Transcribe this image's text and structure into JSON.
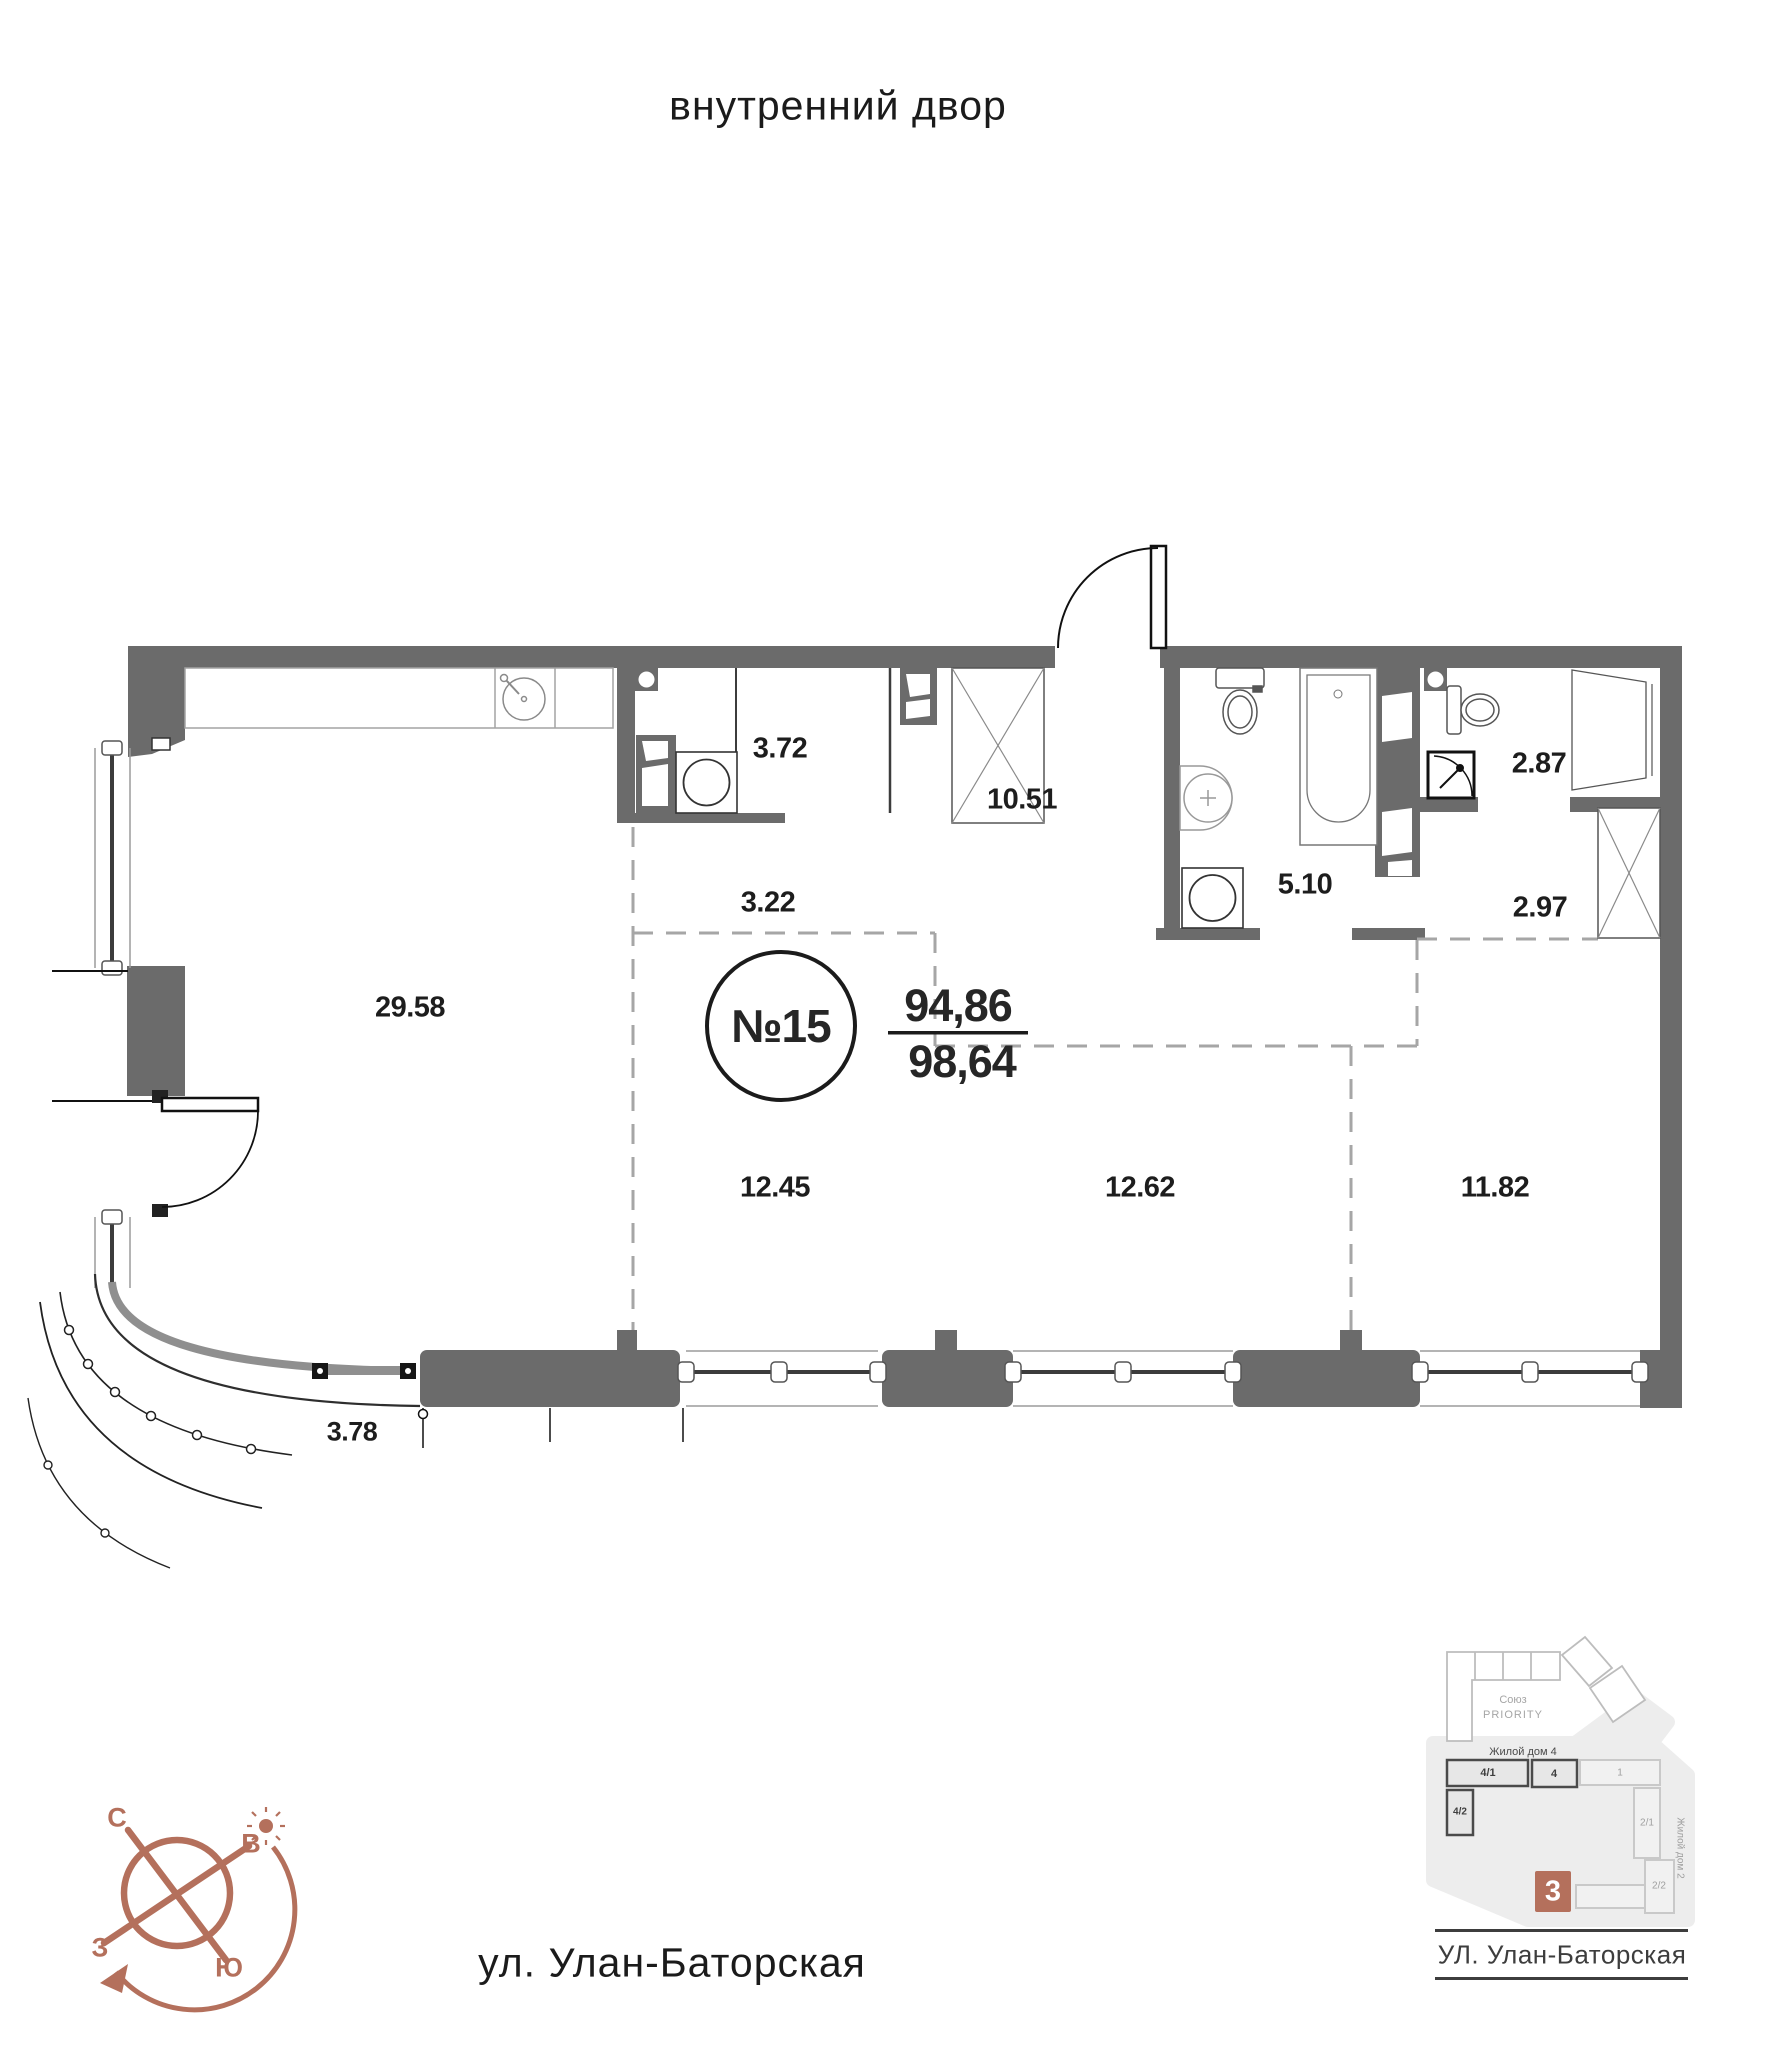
{
  "header": {
    "courtyard_label": "внутренний двор"
  },
  "footer": {
    "street_label": "ул. Улан-Баторская"
  },
  "unit": {
    "number": "№15",
    "area_living": "94,86",
    "area_total": "98,64"
  },
  "rooms": [
    {
      "name": "living-kitchen",
      "area": "29.58"
    },
    {
      "name": "corridor-a",
      "area": "3.22"
    },
    {
      "name": "storage",
      "area": "3.72"
    },
    {
      "name": "hall",
      "area": "10.51"
    },
    {
      "name": "bathroom",
      "area": "5.10"
    },
    {
      "name": "wc",
      "area": "2.87"
    },
    {
      "name": "corridor-b",
      "area": "2.97"
    },
    {
      "name": "bedroom-1",
      "area": "12.45"
    },
    {
      "name": "bedroom-2",
      "area": "12.62"
    },
    {
      "name": "bedroom-3",
      "area": "11.82"
    },
    {
      "name": "balcony",
      "area": "3.78"
    }
  ],
  "compass": {
    "north": "С",
    "east": "В",
    "west": "З",
    "south": "Ю",
    "accent": "#b4705c"
  },
  "minimap": {
    "complex_line1": "Союз",
    "complex_line2": "PRIORITY",
    "building4_label": "Жилой дом 4",
    "building2_label": "Жилой дом 2",
    "blocks": [
      {
        "label": "4/1"
      },
      {
        "label": "4"
      },
      {
        "label": "1"
      },
      {
        "label": "4/2"
      },
      {
        "label": "2/1"
      },
      {
        "label": "2/2"
      }
    ],
    "current_block": "3",
    "street": "УЛ. Улан-Баторская",
    "accent": "#b4705c"
  }
}
